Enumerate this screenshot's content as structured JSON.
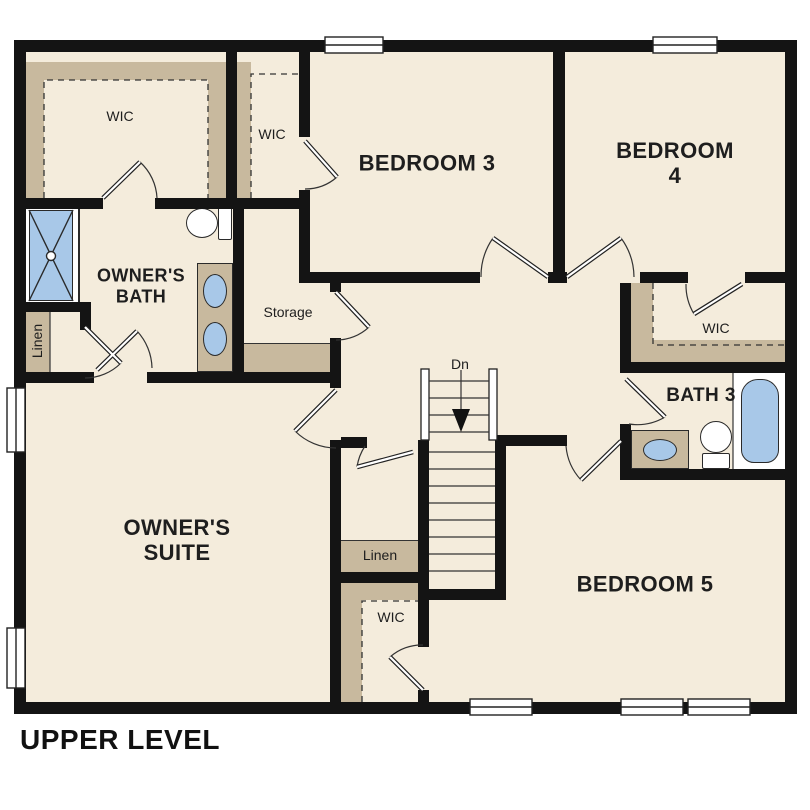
{
  "floor_label": "UPPER LEVEL",
  "colors": {
    "wall": "#141414",
    "floor": "#f4ecdc",
    "closet_shelf_tan": "#c8b99e",
    "fixture_blue": "#a8c8e8",
    "line": "#2a2a2a",
    "background": "#ffffff"
  },
  "rooms": {
    "owners_suite": {
      "label": "OWNER'S\nSUITE"
    },
    "owners_bath": {
      "label": "OWNER'S\nBATH"
    },
    "bedroom_3": {
      "label": "BEDROOM 3"
    },
    "bedroom_4": {
      "label": "BEDROOM 4"
    },
    "bedroom_5": {
      "label": "BEDROOM 5"
    },
    "bath_3": {
      "label": "BATH 3"
    },
    "storage": {
      "label": "Storage"
    },
    "wic_owners": {
      "label": "WIC"
    },
    "wic_bedroom_3": {
      "label": "WIC"
    },
    "wic_bedroom_4": {
      "label": "WIC"
    },
    "wic_bedroom_5": {
      "label": "WIC"
    },
    "linen_owners": {
      "label": "Linen"
    },
    "linen_hall": {
      "label": "Linen"
    }
  },
  "stairs": {
    "direction_label": "Dn"
  }
}
